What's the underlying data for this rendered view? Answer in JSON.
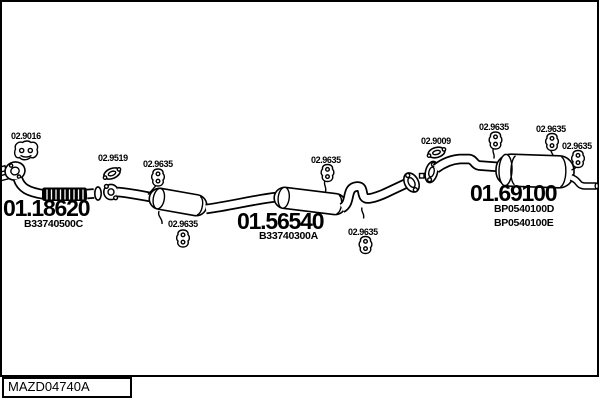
{
  "drawing": {
    "code": "MAZD04740A"
  },
  "callouts": [
    {
      "part_code": "02.9016",
      "icon": "rubber-mount"
    },
    {
      "part_code": "02.9519",
      "icon": "flange-gasket"
    },
    {
      "part_code": "02.9635",
      "icon": "rubber-mount"
    },
    {
      "part_code": "02.9635",
      "icon": "rubber-mount"
    },
    {
      "part_code": "02.9635",
      "icon": "rubber-mount"
    },
    {
      "part_code": "02.9635",
      "icon": "rubber-mount"
    },
    {
      "part_code": "02.9009",
      "icon": "flange-gasket"
    },
    {
      "part_code": "02.9635",
      "icon": "rubber-mount"
    },
    {
      "part_code": "02.9635",
      "icon": "rubber-mount"
    },
    {
      "part_code": "02.9635",
      "icon": "rubber-mount"
    }
  ],
  "parts": [
    {
      "part_number": "01.18620",
      "oem_refs": [
        "B33740500C"
      ]
    },
    {
      "part_number": "01.56540",
      "oem_refs": [
        "B33740300A"
      ]
    },
    {
      "part_number": "01.69100",
      "oem_refs": [
        "BP0540100D",
        "BP0540100E"
      ]
    }
  ]
}
